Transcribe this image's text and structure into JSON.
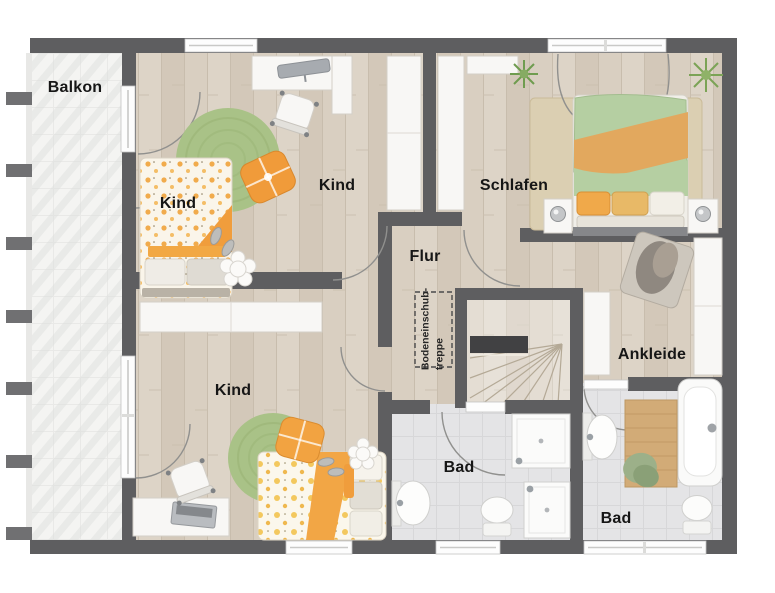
{
  "plan": {
    "type": "floor-plan-upper-storey",
    "labels": {
      "balcony": "Balkon",
      "child_room_bed": "Kind",
      "child_room_top": "Kind",
      "bedroom": "Schlafen",
      "hallway": "Flur",
      "attic_hatch_line1": "Bodeneinschub-",
      "attic_hatch_line2": "treppe",
      "dressing_room": "Ankleide",
      "child_room_bottom": "Kind",
      "bathroom_center": "Bad",
      "bathroom_right": "Bad"
    },
    "colors": {
      "wall": "#5e5e60",
      "wood_floor": "#d8cec1",
      "bath_tile": "#e4e4e6",
      "balcony_tile": "#f4f4f2",
      "rug_green": "#a9c287",
      "accent_orange": "#f09d3c",
      "bed_green": "#b5cfa2",
      "bed_tan": "#e2a85e",
      "furniture_white": "#f8f7f5",
      "label_text": "#161616"
    }
  }
}
